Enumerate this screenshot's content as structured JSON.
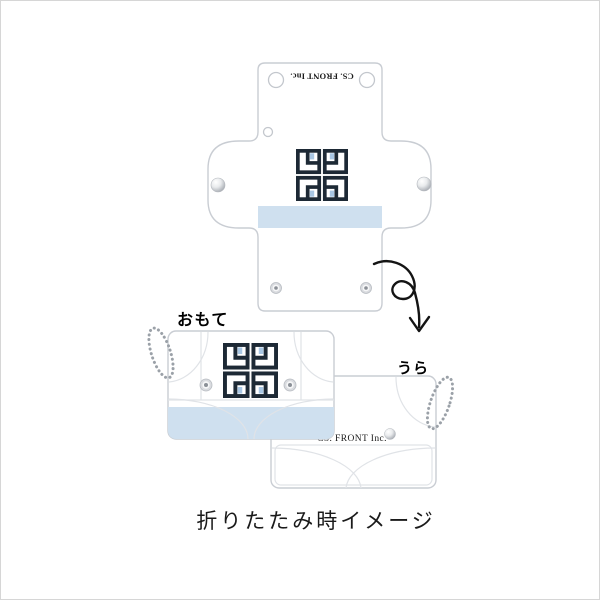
{
  "brand": {
    "name": "CS. FRONT Inc."
  },
  "labels": {
    "front": "おもて",
    "back": "うら"
  },
  "caption": "折りたたみ時イメージ",
  "colors": {
    "band_blue": "#cfe0ef",
    "outline_gray": "#c9cdd3",
    "fold_line_gray": "#e0e3e7",
    "logo_dark": "#1d2935",
    "logo_accent": "#a9c7e4",
    "chain_gray": "#9ba1a8",
    "arrow_black": "#141414"
  }
}
